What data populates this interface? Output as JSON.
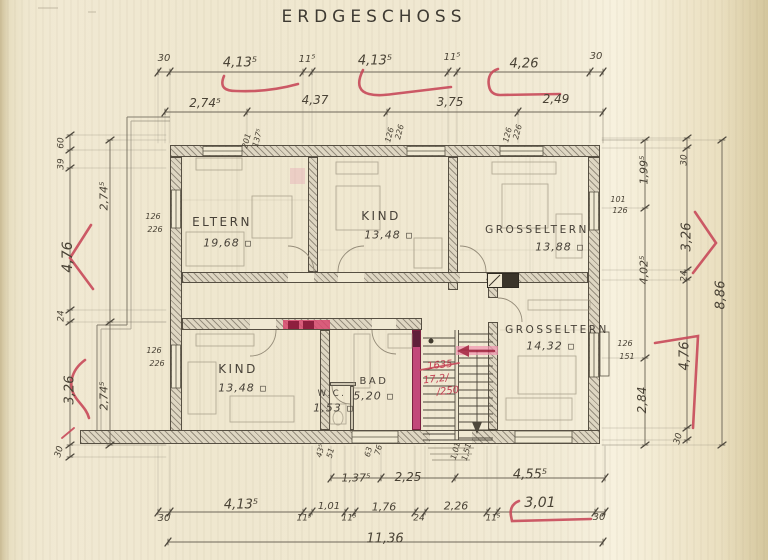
{
  "title": "ERDGESCHOSS",
  "colors": {
    "pencil": "#4a4336",
    "red": "#c13f52",
    "pink_wall": "#c2487a",
    "paper": "#f0e8d1"
  },
  "rooms": [
    {
      "name": "ELTERN",
      "area": "19,68 ▫",
      "nx": 222,
      "ny": 222,
      "ax": 228,
      "ay": 243,
      "ns": 12
    },
    {
      "name": "KIND",
      "area": "13,48 ▫",
      "nx": 381,
      "ny": 216,
      "ax": 389,
      "ay": 235,
      "ns": 12
    },
    {
      "name": "GROSSELTERN",
      "area": "13,88 ▫",
      "nx": 537,
      "ny": 230,
      "ax": 560,
      "ay": 247,
      "ns": 10.5
    },
    {
      "name": "GROSSELTERN",
      "area": "14,32 ▫",
      "nx": 557,
      "ny": 330,
      "ax": 551,
      "ay": 346,
      "ns": 10.5
    },
    {
      "name": "KIND",
      "area": "13,48 ▫",
      "nx": 238,
      "ny": 369,
      "ax": 243,
      "ay": 388,
      "ns": 12
    },
    {
      "name": "BAD",
      "area": "5,20 ▫",
      "nx": 374,
      "ny": 382,
      "ax": 374,
      "ay": 396,
      "ns": 10
    },
    {
      "name": "W.C.",
      "area": "1,53 ▫",
      "nx": 332,
      "ny": 394,
      "ax": 334,
      "ay": 408,
      "ns": 8.5
    }
  ],
  "labels": [
    {
      "t": "30",
      "x": 164,
      "y": 59,
      "s": 10
    },
    {
      "t": "4,13⁵",
      "x": 240,
      "y": 63,
      "s": 13
    },
    {
      "t": "11⁵",
      "x": 307,
      "y": 60,
      "s": 10
    },
    {
      "t": "4,13⁵",
      "x": 375,
      "y": 61,
      "s": 13
    },
    {
      "t": "11⁵",
      "x": 452,
      "y": 58,
      "s": 10
    },
    {
      "t": "4,26",
      "x": 524,
      "y": 64,
      "s": 13
    },
    {
      "t": "30",
      "x": 596,
      "y": 57,
      "s": 10
    },
    {
      "t": "2,74⁵",
      "x": 205,
      "y": 103,
      "s": 12
    },
    {
      "t": "4,37",
      "x": 315,
      "y": 100,
      "s": 12
    },
    {
      "t": "3,75",
      "x": 450,
      "y": 102,
      "s": 12
    },
    {
      "t": "2,49",
      "x": 556,
      "y": 99,
      "s": 12
    },
    {
      "t": "60",
      "x": 62,
      "y": 143,
      "r": -90,
      "s": 9
    },
    {
      "t": "39",
      "x": 62,
      "y": 164,
      "r": -90,
      "s": 9
    },
    {
      "t": "4,76",
      "x": 68,
      "y": 257,
      "r": -90,
      "s": 14
    },
    {
      "t": "24",
      "x": 62,
      "y": 316,
      "r": -90,
      "s": 9
    },
    {
      "t": "3,26",
      "x": 70,
      "y": 390,
      "r": -90,
      "s": 13
    },
    {
      "t": "30",
      "x": 60,
      "y": 452,
      "r": -75,
      "s": 9
    },
    {
      "t": "2,74⁵",
      "x": 104,
      "y": 196,
      "r": -90,
      "s": 11
    },
    {
      "t": "2,74⁵",
      "x": 104,
      "y": 396,
      "r": -90,
      "s": 11
    },
    {
      "t": "1,99⁵",
      "x": 644,
      "y": 170,
      "r": -90,
      "s": 11
    },
    {
      "t": "101",
      "x": 618,
      "y": 200,
      "s": 8
    },
    {
      "t": "126",
      "x": 620,
      "y": 211,
      "s": 8
    },
    {
      "t": "4,02⁵",
      "x": 644,
      "y": 270,
      "r": -90,
      "s": 11
    },
    {
      "t": "126",
      "x": 625,
      "y": 344,
      "s": 8
    },
    {
      "t": "151",
      "x": 627,
      "y": 357,
      "s": 8
    },
    {
      "t": "2,84",
      "x": 642,
      "y": 400,
      "r": -90,
      "s": 12
    },
    {
      "t": "30",
      "x": 685,
      "y": 160,
      "r": -90,
      "s": 9
    },
    {
      "t": "3,26",
      "x": 687,
      "y": 237,
      "r": -90,
      "s": 13
    },
    {
      "t": "24",
      "x": 685,
      "y": 276,
      "r": -90,
      "s": 9
    },
    {
      "t": "4,76",
      "x": 685,
      "y": 356,
      "r": -90,
      "s": 13
    },
    {
      "t": "30",
      "x": 679,
      "y": 439,
      "r": -75,
      "s": 9
    },
    {
      "t": "8,86",
      "x": 721,
      "y": 295,
      "r": -90,
      "s": 13
    },
    {
      "t": "1,37⁵",
      "x": 356,
      "y": 478,
      "s": 11
    },
    {
      "t": "2,25",
      "x": 408,
      "y": 477,
      "s": 12
    },
    {
      "t": "4,55⁵",
      "x": 530,
      "y": 475,
      "s": 13
    },
    {
      "t": "30",
      "x": 164,
      "y": 519,
      "s": 10
    },
    {
      "t": "4,13⁵",
      "x": 241,
      "y": 505,
      "s": 13
    },
    {
      "t": "11⁵",
      "x": 304,
      "y": 519,
      "s": 9
    },
    {
      "t": "1,01",
      "x": 329,
      "y": 507,
      "s": 10
    },
    {
      "t": "11⁵",
      "x": 349,
      "y": 519,
      "s": 9
    },
    {
      "t": "1,76",
      "x": 384,
      "y": 507,
      "s": 11
    },
    {
      "t": "24",
      "x": 419,
      "y": 519,
      "s": 9
    },
    {
      "t": "2,26",
      "x": 456,
      "y": 506,
      "s": 11
    },
    {
      "t": "11⁵",
      "x": 493,
      "y": 519,
      "s": 9
    },
    {
      "t": "3,01",
      "x": 540,
      "y": 503,
      "s": 14
    },
    {
      "t": "30",
      "x": 599,
      "y": 518,
      "s": 10
    },
    {
      "t": "11,36",
      "x": 385,
      "y": 539,
      "s": 13
    },
    {
      "t": "201",
      "x": 247,
      "y": 141,
      "r": -75,
      "s": 8
    },
    {
      "t": "137⁵",
      "x": 258,
      "y": 138,
      "r": -75,
      "s": 8
    },
    {
      "t": "126",
      "x": 390,
      "y": 135,
      "r": -75,
      "s": 8
    },
    {
      "t": "226",
      "x": 400,
      "y": 132,
      "r": -75,
      "s": 8
    },
    {
      "t": "126",
      "x": 508,
      "y": 135,
      "r": -75,
      "s": 8
    },
    {
      "t": "226",
      "x": 518,
      "y": 132,
      "r": -75,
      "s": 8
    },
    {
      "t": "126",
      "x": 153,
      "y": 217,
      "s": 8
    },
    {
      "t": "226",
      "x": 155,
      "y": 230,
      "s": 8
    },
    {
      "t": "126",
      "x": 154,
      "y": 351,
      "s": 8
    },
    {
      "t": "226",
      "x": 157,
      "y": 364,
      "s": 8
    },
    {
      "t": "43⁵",
      "x": 321,
      "y": 451,
      "r": -75,
      "s": 8
    },
    {
      "t": "51",
      "x": 331,
      "y": 453,
      "r": -75,
      "s": 8
    },
    {
      "t": "63",
      "x": 369,
      "y": 452,
      "r": -75,
      "s": 8
    },
    {
      "t": "76",
      "x": 379,
      "y": 450,
      "r": -75,
      "s": 8
    },
    {
      "t": "1,01",
      "x": 456,
      "y": 451,
      "r": -75,
      "s": 8
    },
    {
      "t": "1,51",
      "x": 467,
      "y": 452,
      "r": -75,
      "s": 8
    },
    {
      "t": "1635",
      "x": 440,
      "y": 366,
      "r": -6,
      "s": 10,
      "c": "red"
    },
    {
      "t": "17,2/",
      "x": 436,
      "y": 380,
      "r": -6,
      "s": 10,
      "c": "red"
    },
    {
      "t": "/250",
      "x": 448,
      "y": 392,
      "r": -6,
      "s": 10,
      "c": "red"
    }
  ]
}
